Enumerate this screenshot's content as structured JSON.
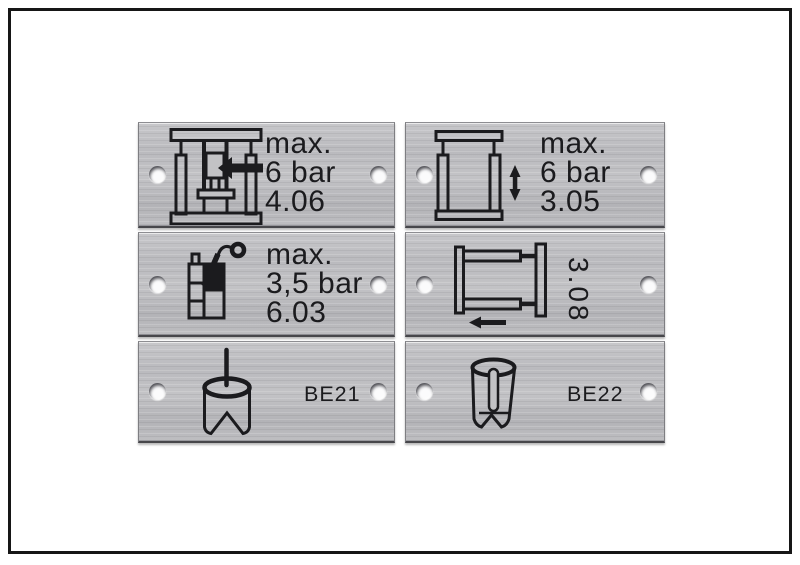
{
  "window": {
    "background": "#ffffff",
    "frame_color": "#161616"
  },
  "colors": {
    "plate_metal": "#bdbdc0",
    "engraving": "#1b1b1e",
    "hole_fill": "#fbfbfc"
  },
  "plates": [
    {
      "position": "top-left",
      "icon": "vertical-press-side-feed-arrow-icon",
      "lines": [
        "max.",
        "6 bar",
        "4.06"
      ]
    },
    {
      "position": "top-right",
      "icon": "press-frame-vertical-stroke-arrow-icon",
      "lines": [
        "max.",
        "6 bar",
        "3.05"
      ]
    },
    {
      "position": "middle-left",
      "icon": "adhesive-container-spray-gun-icon",
      "lines": [
        "max.",
        "3,5 bar",
        "6.03"
      ]
    },
    {
      "position": "middle-right",
      "icon": "horizontal-slide-frame-left-arrow-icon",
      "lines": [
        "3.08"
      ],
      "text_rotation_deg": 90
    },
    {
      "position": "bottom-left",
      "icon": "notched-cylinder-punch-pin-top-icon",
      "lines": [
        "BE21"
      ]
    },
    {
      "position": "bottom-right",
      "icon": "cylinder-cutaway-inner-pin-icon",
      "lines": [
        "BE22"
      ]
    }
  ]
}
